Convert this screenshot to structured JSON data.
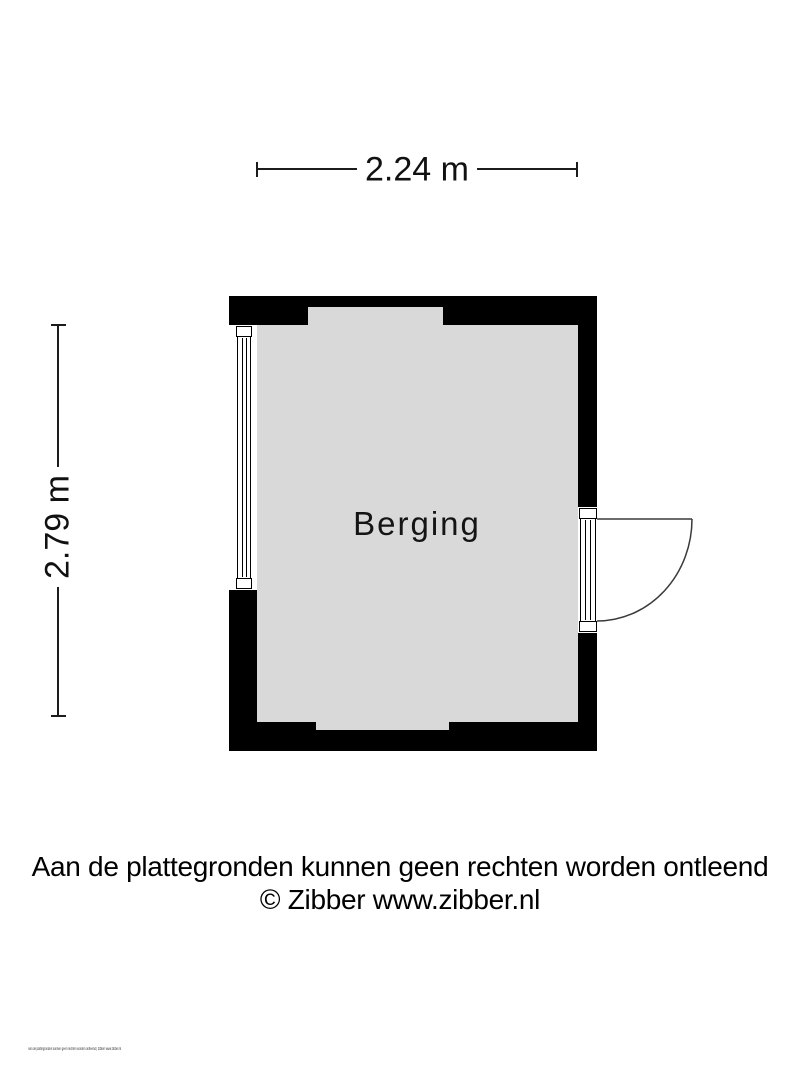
{
  "plan": {
    "room_label": "Berging",
    "dimensions": {
      "width_label": "2.24 m",
      "height_label": "2.79 m"
    }
  },
  "footer": {
    "disclaimer": "Aan de plattegronden kunnen geen rechten worden ontleend",
    "credit": "© Zibber www.zibber.nl",
    "micro_text": "Aan de plattegronden kunnen geen rechten worden ontleend | Zibber www.zibber.nl"
  },
  "colors": {
    "wall": "#000000",
    "floor": "#d9d9d9",
    "background": "#ffffff",
    "stroke": "#3a3a3a"
  }
}
